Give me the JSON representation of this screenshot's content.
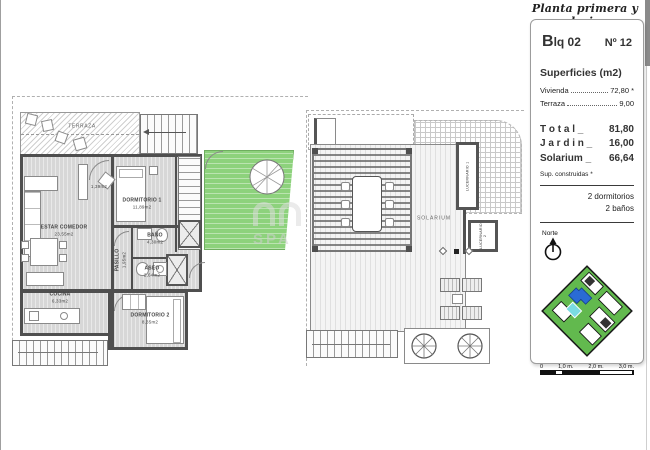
{
  "page": {
    "title_script": "Planta primera y solarium"
  },
  "panel": {
    "block": "Blq 02",
    "unit": "Nº 12",
    "surfaces_title": "Superficies (m2)",
    "surface_rows": [
      {
        "label": "Vivienda",
        "value": "72,80 *"
      },
      {
        "label": "Terraza",
        "value": "9,00"
      }
    ],
    "totals": [
      {
        "label": "T o t a l _",
        "value": "81,80"
      },
      {
        "label": "J a r d i n _",
        "value": "16,00"
      },
      {
        "label": "Solarium _",
        "value": "66,64"
      }
    ],
    "footnote": "Sup. construidas *",
    "features": [
      {
        "text": "2 dormitorios"
      },
      {
        "text": "2 baños"
      }
    ],
    "north_label": "Norte",
    "scale_ticks": [
      {
        "t": "0"
      },
      {
        "t": "1,0 m."
      },
      {
        "t": "2,0 m."
      },
      {
        "t": "3,0 m."
      }
    ]
  },
  "first_floor": {
    "rooms": [
      {
        "name": "TERRAZA",
        "area": ""
      },
      {
        "name": "ESTAR COMEDOR",
        "area": "23,55m2"
      },
      {
        "name": "COCINA",
        "area": "6,33m2"
      },
      {
        "name": "DORMITORIO 1",
        "area": "11,89m2"
      },
      {
        "name": "BAÑO",
        "area": "4,30m2"
      },
      {
        "name": "PASILLO",
        "area": "1,95m2"
      },
      {
        "name": "ASEO",
        "area": "2,64m2"
      },
      {
        "name": "DORMITORIO 2",
        "area": "8,35m2"
      },
      {
        "name": "",
        "area": "1,39m2"
      }
    ]
  },
  "solarium": {
    "label": "SOLARIUM",
    "skylights": [
      {
        "name": "LUCERNARIO 1"
      },
      {
        "name": "LUCERNARIO 2"
      }
    ]
  },
  "watermark": "SPA",
  "colors": {
    "garden_green": "#8dd27c",
    "highlight_blue": "#2a6bd4",
    "pool_cyan": "#7adce2"
  }
}
